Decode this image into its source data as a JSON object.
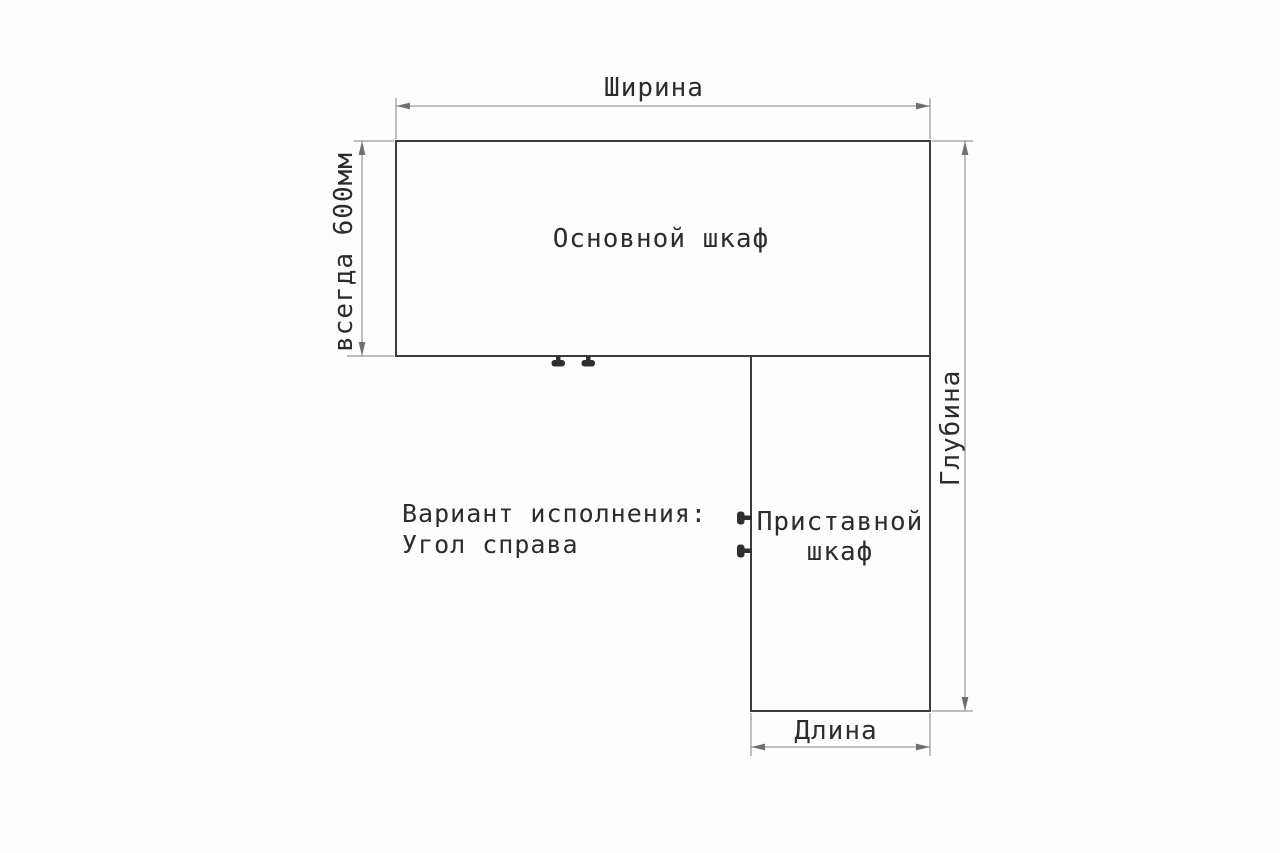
{
  "colors": {
    "background": "#fdfdfd",
    "cabinet_outline": "#3c3c3c",
    "dimension_line": "#7e7e7e",
    "text": "#2c2c2c"
  },
  "diagram": {
    "dimension_labels": {
      "width": "Ширина",
      "depth": "Глубина",
      "length": "Длина",
      "fixed_depth": "всегда 600мм"
    },
    "cabinet_labels": {
      "main": "Основной шкаф",
      "attached_line1": "Приставной",
      "attached_line2": "шкаф"
    },
    "variant_note": {
      "line1": "Вариант исполнения:",
      "line2": "Угол справа"
    },
    "icons": {
      "main_cabinet_handles": "door-handle-icon",
      "attached_cabinet_handles": "door-handle-icon"
    }
  }
}
